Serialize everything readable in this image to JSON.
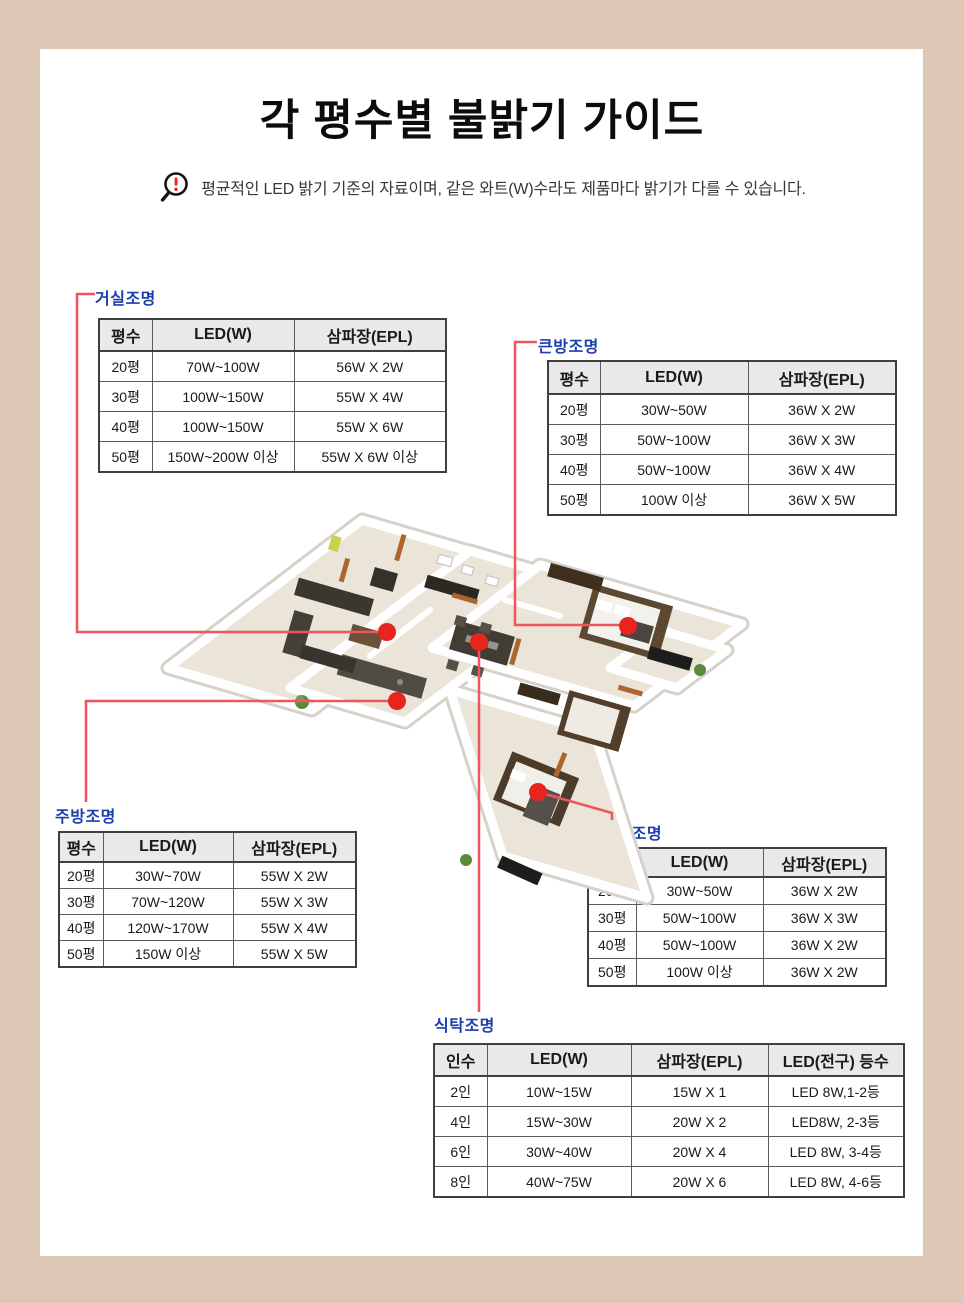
{
  "page": {
    "title": "각 평수별 불밝기 가이드",
    "notice": "평균적인 LED 밝기 기준의 자료이며, 같은 와트(W)수라도 제품마다 밝기가 다를 수 있습니다.",
    "notice_icon": "magnifier-exclamation-icon"
  },
  "colors": {
    "frame_beige": "#ddc8b6",
    "label_blue": "#1d3fae",
    "connector_red": "#f0545c",
    "dot_red": "#e8241f",
    "table_header_bg": "#e9e9e9"
  },
  "tables": {
    "living": {
      "label": "거실조명",
      "headers": [
        "평수",
        "LED(W)",
        "삼파장(EPL)"
      ],
      "rows": [
        [
          "20평",
          "70W~100W",
          "56W X 2W"
        ],
        [
          "30평",
          "100W~150W",
          "55W X 4W"
        ],
        [
          "40평",
          "100W~150W",
          "55W X 6W"
        ],
        [
          "50평",
          "150W~200W 이상",
          "55W X 6W 이상"
        ]
      ]
    },
    "bigroom": {
      "label": "큰방조명",
      "headers": [
        "평수",
        "LED(W)",
        "삼파장(EPL)"
      ],
      "rows": [
        [
          "20평",
          "30W~50W",
          "36W X 2W"
        ],
        [
          "30평",
          "50W~100W",
          "36W X 3W"
        ],
        [
          "40평",
          "50W~100W",
          "36W X 4W"
        ],
        [
          "50평",
          "100W 이상",
          "36W X 5W"
        ]
      ]
    },
    "kitchen": {
      "label": "주방조명",
      "headers": [
        "평수",
        "LED(W)",
        "삼파장(EPL)"
      ],
      "rows": [
        [
          "20평",
          "30W~70W",
          "55W X 2W"
        ],
        [
          "30평",
          "70W~120W",
          "55W X 3W"
        ],
        [
          "40평",
          "120W~170W",
          "55W X 4W"
        ],
        [
          "50평",
          "150W 이상",
          "55W X 5W"
        ]
      ]
    },
    "smallroom": {
      "label": "작은방조명",
      "headers": [
        "평수",
        "LED(W)",
        "삼파장(EPL)"
      ],
      "rows": [
        [
          "20평",
          "30W~50W",
          "36W X 2W"
        ],
        [
          "30평",
          "50W~100W",
          "36W X 3W"
        ],
        [
          "40평",
          "50W~100W",
          "36W X 2W"
        ],
        [
          "50평",
          "100W 이상",
          "36W X 2W"
        ]
      ]
    },
    "dining": {
      "label": "식탁조명",
      "headers": [
        "인수",
        "LED(W)",
        "삼파장(EPL)",
        "LED(전구) 등수"
      ],
      "rows": [
        [
          "2인",
          "10W~15W",
          "15W X 1",
          "LED 8W,1-2등"
        ],
        [
          "4인",
          "15W~30W",
          "20W X 2",
          "LED8W, 2-3등"
        ],
        [
          "6인",
          "30W~40W",
          "20W X 4",
          "LED 8W, 3-4등"
        ],
        [
          "8인",
          "40W~75W",
          "20W X 6",
          "LED 8W, 4-6등"
        ]
      ]
    }
  }
}
